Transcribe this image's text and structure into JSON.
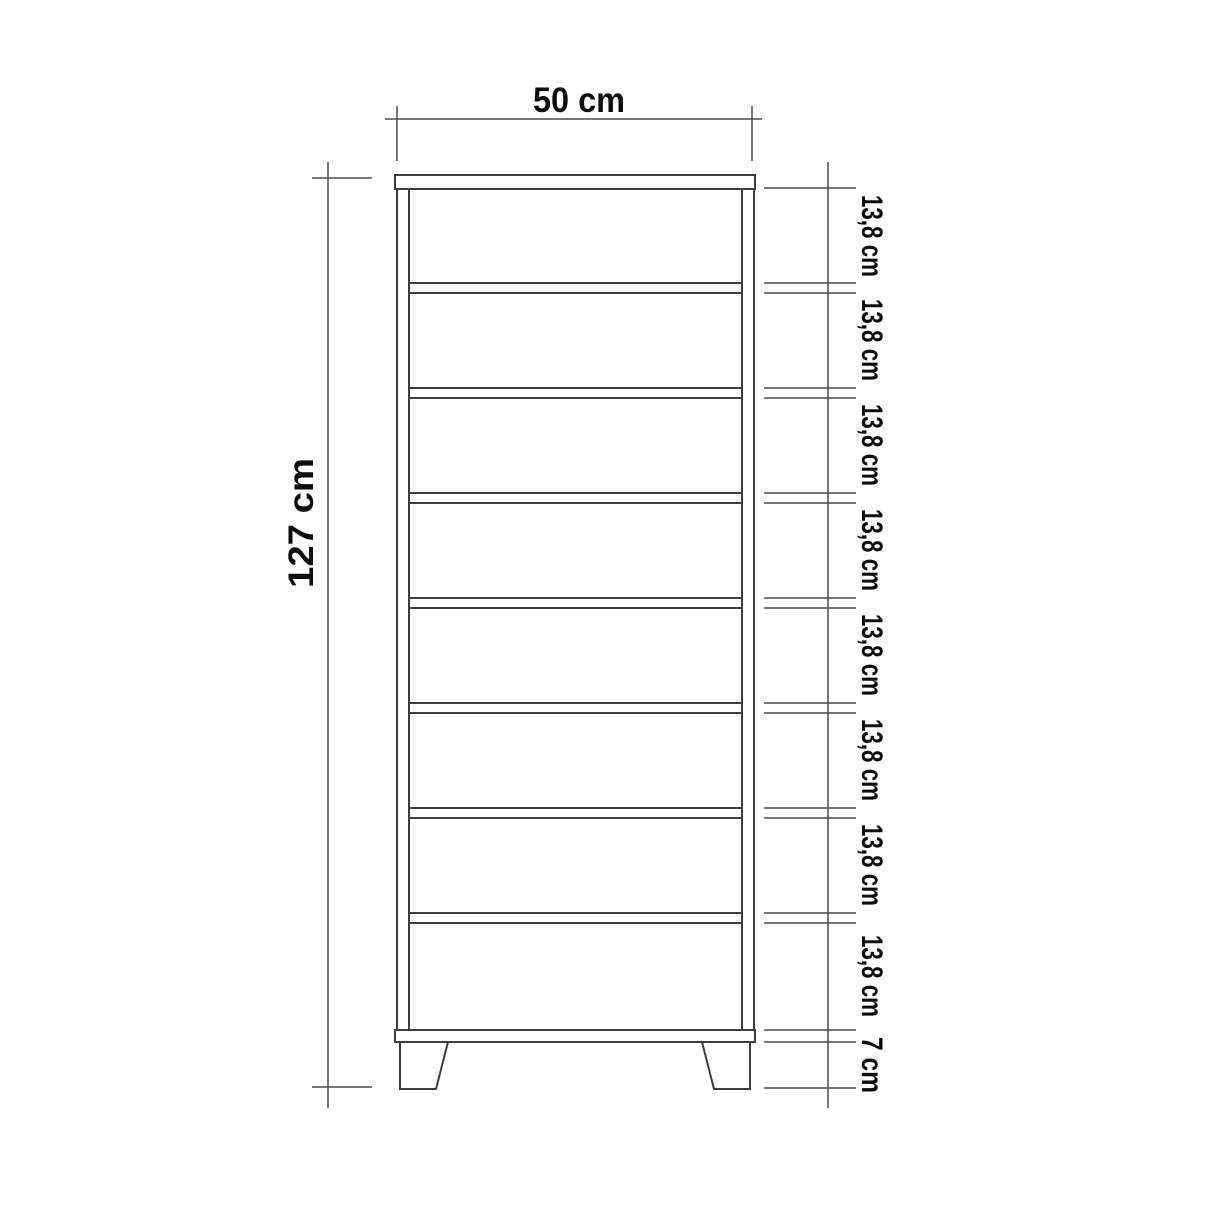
{
  "diagram": {
    "subject": "cabinet-front-elevation-dimension-drawing",
    "background_color": "#ffffff",
    "line_color": "#3d3d3d",
    "dimension_line_color": "#4a4a4a",
    "text_color": "#0d0d0d",
    "top_dimension": {
      "label": "50 cm",
      "value_cm": 50
    },
    "left_dimension": {
      "label": "127 cm",
      "value_cm": 127
    },
    "right_segments": [
      {
        "label": "13,8 cm"
      },
      {
        "label": "13,8 cm"
      },
      {
        "label": "13,8 cm"
      },
      {
        "label": "13,8 cm"
      },
      {
        "label": "13,8 cm"
      },
      {
        "label": "13,8 cm"
      },
      {
        "label": "13,8 cm"
      },
      {
        "label": "13,8 cm"
      },
      {
        "label": "7 cm"
      }
    ],
    "measurements": {
      "width_cm": 50,
      "height_cm": 127,
      "compartment_count": 8,
      "compartment_height_label": "13,8 cm",
      "leg_height_label": "7 cm"
    }
  }
}
